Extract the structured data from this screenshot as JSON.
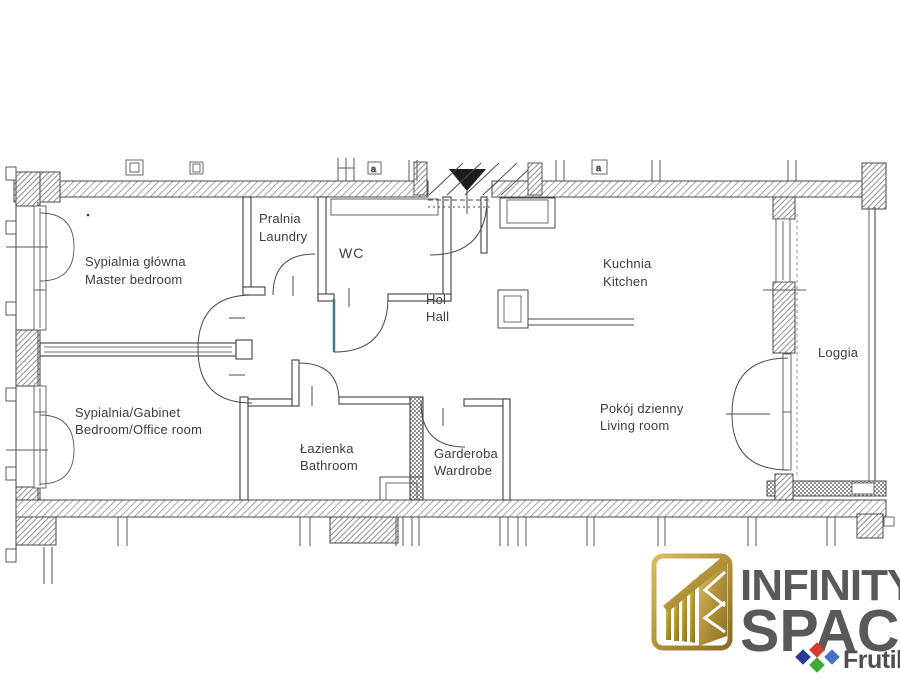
{
  "canvas": {
    "width": 900,
    "height": 675,
    "background": "#ffffff",
    "ink": "#4a4a4a",
    "hatch": "#8d8d8d",
    "accent_teal": "#3e7d7d"
  },
  "plan": {
    "type": "apartment-floor-plan",
    "rooms": [
      {
        "name_pl": "Sypialnia główna",
        "name_en": "Master bedroom"
      },
      {
        "name_pl": "Pralnia",
        "name_en": "Laundry"
      },
      {
        "name_pl": "WC",
        "name_en": ""
      },
      {
        "name_pl": "Hol",
        "name_en": "Hall"
      },
      {
        "name_pl": "Kuchnia",
        "name_en": "Kitchen"
      },
      {
        "name_pl": "Loggia",
        "name_en": ""
      },
      {
        "name_pl": "Sypialnia/Gabinet",
        "name_en": "Bedroom/Office room"
      },
      {
        "name_pl": "Łazienka",
        "name_en": "Bathroom"
      },
      {
        "name_pl": "Garderoba",
        "name_en": "Wardrobe"
      },
      {
        "name_pl": "Pokój dzienny",
        "name_en": "Living room"
      }
    ],
    "marker_label": "a"
  },
  "branding": {
    "brand_line1": "INFINITY",
    "brand_line2": "SPACE",
    "partner": "Frutils",
    "colors": {
      "gold": "#b29238",
      "brand_text": "#58595b",
      "partner_text": "#4d4d4d",
      "diamond_red": "#d63a2f",
      "diamond_navy": "#2b3990",
      "diamond_blue": "#4472c4",
      "diamond_green": "#3faa35"
    }
  }
}
